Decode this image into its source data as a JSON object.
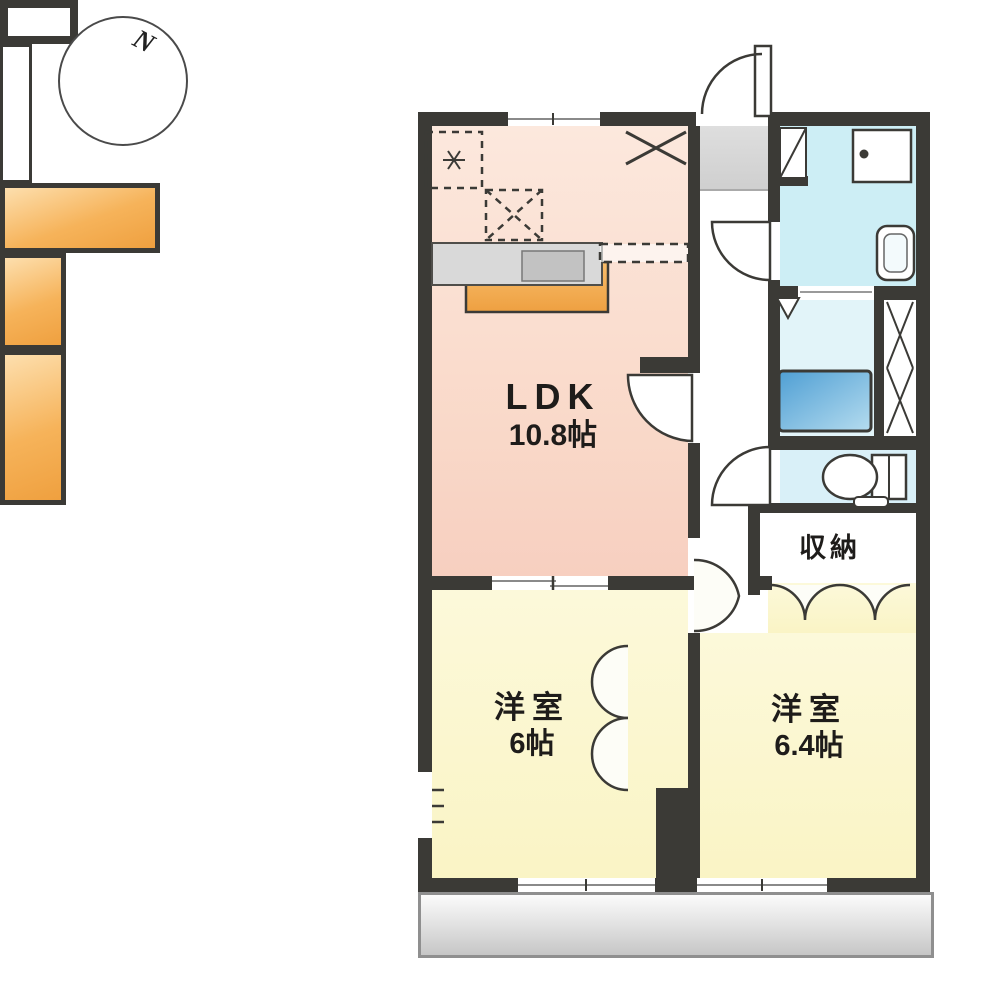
{
  "compass": {
    "north_label": "N"
  },
  "rooms": {
    "ldk": {
      "name": "LDK",
      "size": "10.8帖"
    },
    "bedroom_west": {
      "name": "洋室",
      "size": "6帖"
    },
    "bedroom_east": {
      "name": "洋室",
      "size": "6.4帖"
    },
    "storage": {
      "name": "収納"
    }
  },
  "colors": {
    "wall": "#3b3a36",
    "ldk_floor": "#f9d8c8",
    "bedroom_floor": "#faf4c5",
    "wet_area_floor": "#cdeef5",
    "closet_orange": "#f6b35a",
    "bathtub_blue": "#57a5d8",
    "balcony_gray": "#d9d9d9"
  }
}
